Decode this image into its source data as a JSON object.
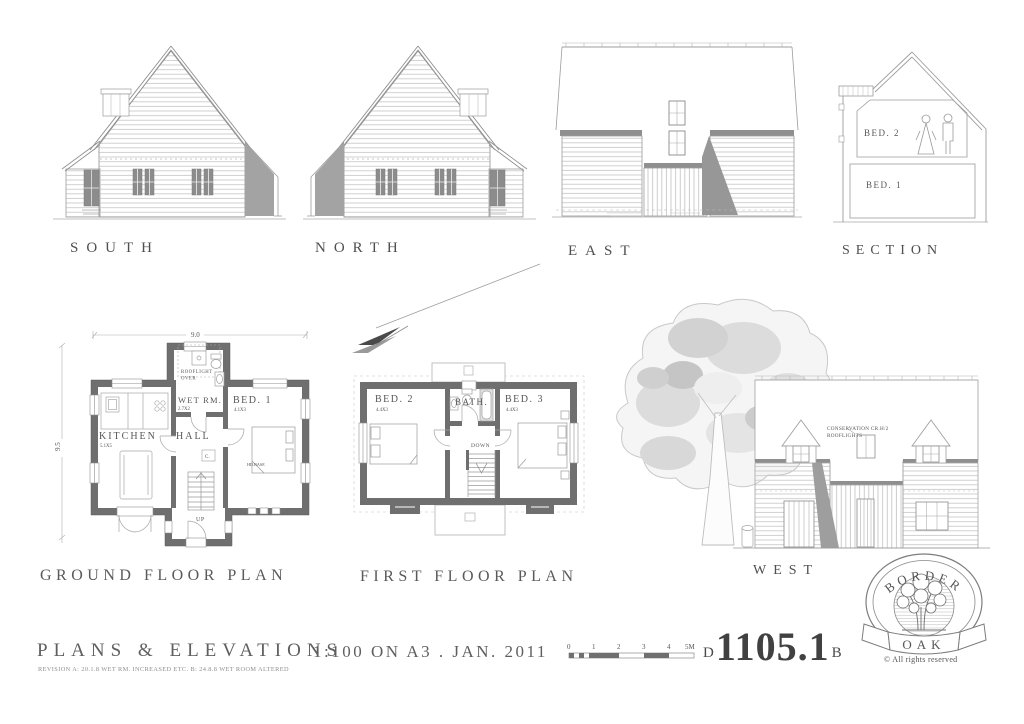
{
  "colors": {
    "wall_fill": "#6f6f6f",
    "shadow": "#9e9e9e",
    "line": "#9a9a9a",
    "text": "#555555",
    "tree_light": "#e0e0e0"
  },
  "elevation_labels": {
    "south": "SOUTH",
    "north": "NORTH",
    "east": "EAST",
    "section": "SECTION",
    "west": "WEST"
  },
  "section_view": {
    "bed2": "BED. 2",
    "bed1": "BED. 1"
  },
  "ground_floor": {
    "title": "GROUND FLOOR PLAN",
    "dim_width": "9.0",
    "dim_height": "9.5",
    "rooflight_line1": "ROOFLIGHT",
    "rooflight_line2": "OVER",
    "wet_room": "WET RM.",
    "wet_room_dim": "2.7X2",
    "bed1": "BED. 1",
    "bed1_dim": "4.1X3",
    "kitchen": "KITCHEN",
    "kitchen_dim": "5.1X5",
    "hall": "HALL",
    "bed_note": "HD.BASE",
    "cupboard": "C.",
    "stairs": "UP"
  },
  "first_floor": {
    "title": "FIRST FLOOR PLAN",
    "bed2": "BED. 2",
    "bed2_dim": "4.4X3",
    "bath": "BATH.",
    "bed3": "BED. 3",
    "bed3_dim": "4.4X3",
    "stairs": "DOWN"
  },
  "west_view": {
    "note_line1": "CONSERVATION CR.H/2",
    "note_line2": "ROOFLIGHTS"
  },
  "title_block": {
    "title": "PLANS & ELEVATIONS",
    "revision_note": "REVISION  A: 20.1.8 WET RM. INCREASED ETC.   B: 24.8.8 WET ROOM ALTERED",
    "scale_and_date": "1:100 ON A3   .   JAN. 2011",
    "drawing_prefix": "D",
    "drawing_number": "1105.1",
    "drawing_revision": "B",
    "scale_bar_ticks": [
      "0",
      "1",
      "2",
      "3",
      "4",
      "5M"
    ]
  },
  "logo": {
    "arc_text": "BORDER",
    "banner_text": "OAK",
    "copyright": "© All rights reserved"
  }
}
